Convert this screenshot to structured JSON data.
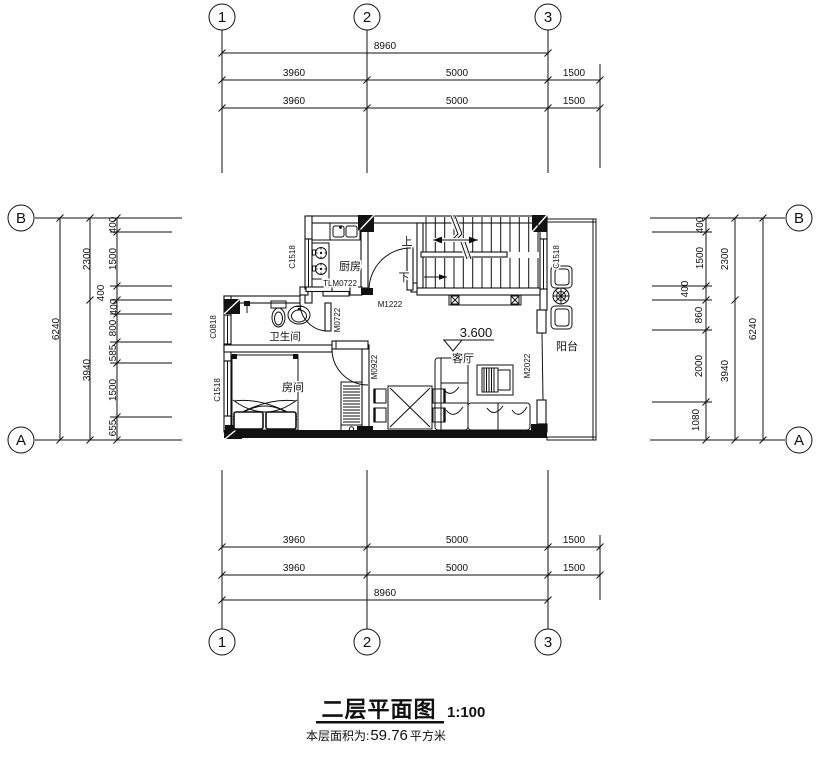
{
  "title": {
    "main": "二层平面图",
    "scale": "1:100",
    "area_label": "本层面积为:",
    "area_value": "59.76",
    "area_unit": "平方米"
  },
  "grid": {
    "c1": "1",
    "c2": "2",
    "c3": "3",
    "rA": "A",
    "rB": "B"
  },
  "dims": {
    "top": {
      "overall": "8960",
      "r1": [
        "3960",
        "5000",
        "1500"
      ],
      "r2": [
        "3960",
        "5000",
        "1500"
      ]
    },
    "bottom": {
      "overall": "8960",
      "r1": [
        "3960",
        "5000",
        "1500"
      ],
      "r2": [
        "3960",
        "5000",
        "1500"
      ]
    },
    "left": {
      "overall": "6240",
      "mid": [
        "2300",
        "3940"
      ],
      "inner": [
        "400",
        "1500",
        "400",
        "400",
        "800",
        "585",
        "1500",
        "655"
      ]
    },
    "right": {
      "overall": "6240",
      "mid": [
        "2300",
        "3940"
      ],
      "inner": [
        "400",
        "1500",
        "400",
        "860",
        "2000",
        "1080"
      ]
    }
  },
  "rooms": {
    "kitchen": "厨房",
    "bathroom": "卫生间",
    "bedroom": "房间",
    "living": "客厅",
    "balcony": "阳台"
  },
  "stairs": {
    "up": "上",
    "down": "下"
  },
  "level": {
    "value": "3.600"
  },
  "openings": {
    "tlm0722": "TLM0722",
    "m1222": "M1222",
    "m0722": "M0722",
    "m0922": "M0922",
    "m2022": "M2022",
    "c1518": "C1518",
    "c0818": "C0818"
  }
}
